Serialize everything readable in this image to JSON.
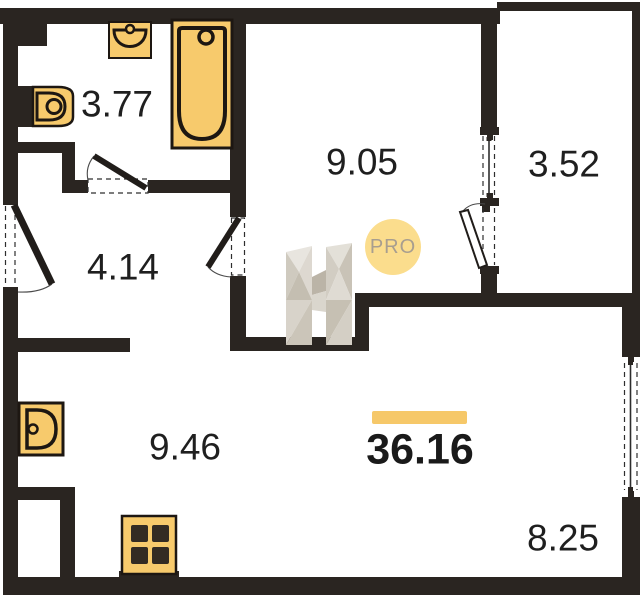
{
  "page": {
    "type": "floor-plan"
  },
  "branding": {
    "badge_label": "PRO",
    "logo": "h-logo"
  },
  "total": {
    "area": "36.16"
  },
  "rooms": [
    {
      "id": "bathroom",
      "area": "3.77"
    },
    {
      "id": "room",
      "area": "9.05"
    },
    {
      "id": "balcony",
      "area": "3.52"
    },
    {
      "id": "hallway",
      "area": "4.14"
    },
    {
      "id": "kitchen",
      "area": "9.46"
    },
    {
      "id": "living-room",
      "area": "8.25"
    }
  ],
  "icons": [
    "washbasin-icon",
    "bathtub-icon",
    "toilet-icon",
    "kitchen-sink-icon",
    "stove-icon",
    "h-logo",
    "pro-badge"
  ],
  "colors": {
    "wall": "#2a2521",
    "fixture_fill": "#f7ca6c",
    "fixture_outline": "#1d1712",
    "accent_bar": "#f6c869",
    "badge_fill": "#fbdd8d",
    "badge_text": "#a89e8f",
    "label_text": "#1f1f1f",
    "background": "#ffffff"
  }
}
